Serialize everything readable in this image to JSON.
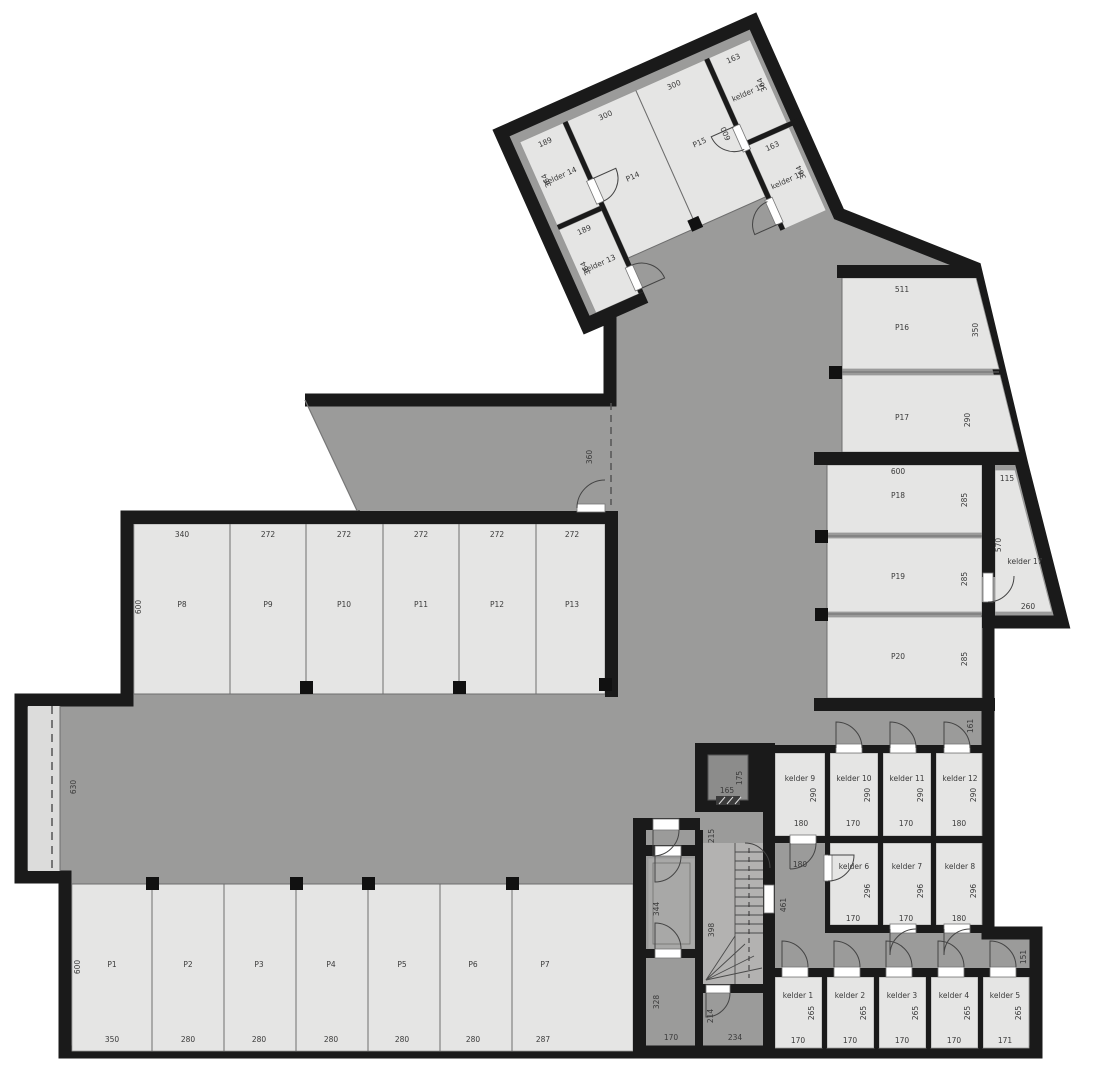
{
  "plan": {
    "type": "architectural-floor-plan",
    "floor": "basement parking / storage level",
    "colors": {
      "wall": "#1a1a1a",
      "room_fill": "#e5e5e4",
      "circulation_fill": "#9b9b9a",
      "ramp_fill": "#dcdcdb",
      "stair_fill": "#b3b2b1",
      "elevator_fill": "#8c8c8b",
      "background": "#ffffff"
    },
    "parking_spaces": [
      "P1",
      "P2",
      "P3",
      "P4",
      "P5",
      "P6",
      "P7",
      "P8",
      "P9",
      "P10",
      "P11",
      "P12",
      "P13",
      "P14",
      "P15",
      "P16",
      "P17",
      "P18",
      "P19",
      "P20"
    ],
    "storage_rooms": [
      "kelder 1",
      "kelder 2",
      "kelder 3",
      "kelder 4",
      "kelder 5",
      "kelder 6",
      "kelder 7",
      "kelder 8",
      "kelder 9",
      "kelder 10",
      "kelder 11",
      "kelder 12",
      "kelder 13",
      "kelder 14",
      "kelder 15",
      "kelder 16",
      "kelder 17"
    ],
    "labels": [
      {
        "t": "189",
        "x": 35,
        "y": 25,
        "w": 1
      },
      {
        "t": "kelder 14",
        "x": 35,
        "y": 62,
        "w": 1,
        "n": "room-label-kelder-14"
      },
      {
        "t": "364",
        "x": 23,
        "y": 58,
        "v": 1,
        "w": 1
      },
      {
        "t": "189",
        "x": 35,
        "y": 121,
        "w": 1
      },
      {
        "t": "kelder 13",
        "x": 35,
        "y": 158,
        "w": 1,
        "n": "room-label-kelder-13"
      },
      {
        "t": "364",
        "x": 23,
        "y": 154,
        "v": 1,
        "w": 1
      },
      {
        "t": "300",
        "x": 101,
        "y": 25,
        "w": 1
      },
      {
        "t": "P14",
        "x": 101,
        "y": 92,
        "w": 1,
        "n": "room-label-p14"
      },
      {
        "t": "300",
        "x": 176,
        "y": 25,
        "w": 1
      },
      {
        "t": "P15",
        "x": 176,
        "y": 88,
        "w": 1,
        "n": "room-label-p15"
      },
      {
        "t": "600",
        "x": 206,
        "y": 88,
        "v": 1,
        "w": 1
      },
      {
        "t": "163",
        "x": 241,
        "y": 25,
        "w": 1
      },
      {
        "t": "kelder 15",
        "x": 241,
        "y": 62,
        "w": 1,
        "n": "room-label-kelder-15"
      },
      {
        "t": "364",
        "x": 259,
        "y": 58,
        "v": 1,
        "w": 1
      },
      {
        "t": "163",
        "x": 241,
        "y": 121,
        "w": 1
      },
      {
        "t": "kelder 16",
        "x": 241,
        "y": 158,
        "w": 1,
        "n": "room-label-kelder-16"
      },
      {
        "t": "364",
        "x": 259,
        "y": 154,
        "v": 1,
        "w": 1
      },
      {
        "t": "340",
        "x": 182,
        "y": 537
      },
      {
        "t": "P8",
        "x": 182,
        "y": 607,
        "n": "room-label-p8"
      },
      {
        "t": "600",
        "x": 141,
        "y": 607,
        "v": 1
      },
      {
        "t": "272",
        "x": 268,
        "y": 537
      },
      {
        "t": "P9",
        "x": 268,
        "y": 607,
        "n": "room-label-p9"
      },
      {
        "t": "272",
        "x": 344,
        "y": 537
      },
      {
        "t": "P10",
        "x": 344,
        "y": 607,
        "n": "room-label-p10"
      },
      {
        "t": "272",
        "x": 421,
        "y": 537
      },
      {
        "t": "P11",
        "x": 421,
        "y": 607,
        "n": "room-label-p11"
      },
      {
        "t": "272",
        "x": 497,
        "y": 537
      },
      {
        "t": "P12",
        "x": 497,
        "y": 607,
        "n": "room-label-p12"
      },
      {
        "t": "272",
        "x": 572,
        "y": 537
      },
      {
        "t": "P13",
        "x": 572,
        "y": 607,
        "n": "room-label-p13"
      },
      {
        "t": "360",
        "x": 592,
        "y": 457,
        "v": 1
      },
      {
        "t": "630",
        "x": 76,
        "y": 787,
        "v": 1
      },
      {
        "t": "P1",
        "x": 112,
        "y": 967,
        "n": "room-label-p1"
      },
      {
        "t": "600",
        "x": 80,
        "y": 967,
        "v": 1
      },
      {
        "t": "350",
        "x": 112,
        "y": 1042
      },
      {
        "t": "P2",
        "x": 188,
        "y": 967,
        "n": "room-label-p2"
      },
      {
        "t": "280",
        "x": 188,
        "y": 1042
      },
      {
        "t": "P3",
        "x": 259,
        "y": 967,
        "n": "room-label-p3"
      },
      {
        "t": "280",
        "x": 259,
        "y": 1042
      },
      {
        "t": "P4",
        "x": 331,
        "y": 967,
        "n": "room-label-p4"
      },
      {
        "t": "280",
        "x": 331,
        "y": 1042
      },
      {
        "t": "P5",
        "x": 402,
        "y": 967,
        "n": "room-label-p5"
      },
      {
        "t": "280",
        "x": 402,
        "y": 1042
      },
      {
        "t": "P6",
        "x": 473,
        "y": 967,
        "n": "room-label-p6"
      },
      {
        "t": "280",
        "x": 473,
        "y": 1042
      },
      {
        "t": "P7",
        "x": 545,
        "y": 967,
        "n": "room-label-p7"
      },
      {
        "t": "287",
        "x": 543,
        "y": 1042
      },
      {
        "t": "511",
        "x": 902,
        "y": 292
      },
      {
        "t": "P16",
        "x": 902,
        "y": 330,
        "n": "room-label-p16"
      },
      {
        "t": "350",
        "x": 978,
        "y": 330,
        "v": 1
      },
      {
        "t": "P17",
        "x": 902,
        "y": 420,
        "n": "room-label-p17"
      },
      {
        "t": "290",
        "x": 970,
        "y": 420,
        "v": 1
      },
      {
        "t": "600",
        "x": 898,
        "y": 474
      },
      {
        "t": "P18",
        "x": 898,
        "y": 498,
        "n": "room-label-p18"
      },
      {
        "t": "285",
        "x": 967,
        "y": 500,
        "v": 1
      },
      {
        "t": "P19",
        "x": 898,
        "y": 579,
        "n": "room-label-p19"
      },
      {
        "t": "285",
        "x": 967,
        "y": 579,
        "v": 1
      },
      {
        "t": "P20",
        "x": 898,
        "y": 659,
        "n": "room-label-p20"
      },
      {
        "t": "285",
        "x": 967,
        "y": 659,
        "v": 1
      },
      {
        "t": "115",
        "x": 1007,
        "y": 481
      },
      {
        "t": "570",
        "x": 1001,
        "y": 545,
        "v": 1
      },
      {
        "t": "kelder 17",
        "x": 1025,
        "y": 564,
        "n": "room-label-kelder-17"
      },
      {
        "t": "260",
        "x": 1028,
        "y": 609
      },
      {
        "t": "161",
        "x": 973,
        "y": 726,
        "v": 1
      },
      {
        "t": "kelder 9",
        "x": 800,
        "y": 781,
        "n": "room-label-kelder-9"
      },
      {
        "t": "290",
        "x": 816,
        "y": 795,
        "v": 1
      },
      {
        "t": "180",
        "x": 801,
        "y": 826
      },
      {
        "t": "kelder 10",
        "x": 854,
        "y": 781,
        "n": "room-label-kelder-10"
      },
      {
        "t": "290",
        "x": 870,
        "y": 795,
        "v": 1
      },
      {
        "t": "170",
        "x": 853,
        "y": 826
      },
      {
        "t": "kelder 11",
        "x": 907,
        "y": 781,
        "n": "room-label-kelder-11"
      },
      {
        "t": "290",
        "x": 923,
        "y": 795,
        "v": 1
      },
      {
        "t": "170",
        "x": 906,
        "y": 826
      },
      {
        "t": "kelder 12",
        "x": 960,
        "y": 781,
        "n": "room-label-kelder-12"
      },
      {
        "t": "290",
        "x": 976,
        "y": 795,
        "v": 1
      },
      {
        "t": "180",
        "x": 959,
        "y": 826
      },
      {
        "t": "180",
        "x": 800,
        "y": 867
      },
      {
        "t": "461",
        "x": 786,
        "y": 905,
        "v": 1
      },
      {
        "t": "kelder 6",
        "x": 854,
        "y": 869,
        "n": "room-label-kelder-6"
      },
      {
        "t": "296",
        "x": 870,
        "y": 891,
        "v": 1
      },
      {
        "t": "170",
        "x": 853,
        "y": 921
      },
      {
        "t": "kelder 7",
        "x": 907,
        "y": 869,
        "n": "room-label-kelder-7"
      },
      {
        "t": "296",
        "x": 923,
        "y": 891,
        "v": 1
      },
      {
        "t": "170",
        "x": 906,
        "y": 921
      },
      {
        "t": "kelder 8",
        "x": 960,
        "y": 869,
        "n": "room-label-kelder-8"
      },
      {
        "t": "296",
        "x": 976,
        "y": 891,
        "v": 1
      },
      {
        "t": "180",
        "x": 959,
        "y": 921
      },
      {
        "t": "151",
        "x": 1026,
        "y": 957,
        "v": 1
      },
      {
        "t": "kelder 1",
        "x": 798,
        "y": 998,
        "n": "room-label-kelder-1"
      },
      {
        "t": "265",
        "x": 814,
        "y": 1013,
        "v": 1
      },
      {
        "t": "170",
        "x": 798,
        "y": 1043
      },
      {
        "t": "kelder 2",
        "x": 850,
        "y": 998,
        "n": "room-label-kelder-2"
      },
      {
        "t": "265",
        "x": 866,
        "y": 1013,
        "v": 1
      },
      {
        "t": "170",
        "x": 850,
        "y": 1043
      },
      {
        "t": "kelder 3",
        "x": 902,
        "y": 998,
        "n": "room-label-kelder-3"
      },
      {
        "t": "265",
        "x": 918,
        "y": 1013,
        "v": 1
      },
      {
        "t": "170",
        "x": 902,
        "y": 1043
      },
      {
        "t": "kelder 4",
        "x": 954,
        "y": 998,
        "n": "room-label-kelder-4"
      },
      {
        "t": "265",
        "x": 970,
        "y": 1013,
        "v": 1
      },
      {
        "t": "170",
        "x": 954,
        "y": 1043
      },
      {
        "t": "kelder 5",
        "x": 1005,
        "y": 998,
        "n": "room-label-kelder-5"
      },
      {
        "t": "265",
        "x": 1021,
        "y": 1013,
        "v": 1
      },
      {
        "t": "171",
        "x": 1005,
        "y": 1043
      },
      {
        "t": "165",
        "x": 727,
        "y": 793
      },
      {
        "t": "175",
        "x": 742,
        "y": 778,
        "v": 1
      },
      {
        "t": "215",
        "x": 714,
        "y": 836,
        "v": 1
      },
      {
        "t": "344",
        "x": 659,
        "y": 909,
        "v": 1
      },
      {
        "t": "398",
        "x": 714,
        "y": 930,
        "v": 1
      },
      {
        "t": "328",
        "x": 659,
        "y": 1002,
        "v": 1
      },
      {
        "t": "170",
        "x": 671,
        "y": 1040
      },
      {
        "t": "214",
        "x": 713,
        "y": 1016,
        "v": 1
      },
      {
        "t": "234",
        "x": 735,
        "y": 1040
      }
    ]
  }
}
